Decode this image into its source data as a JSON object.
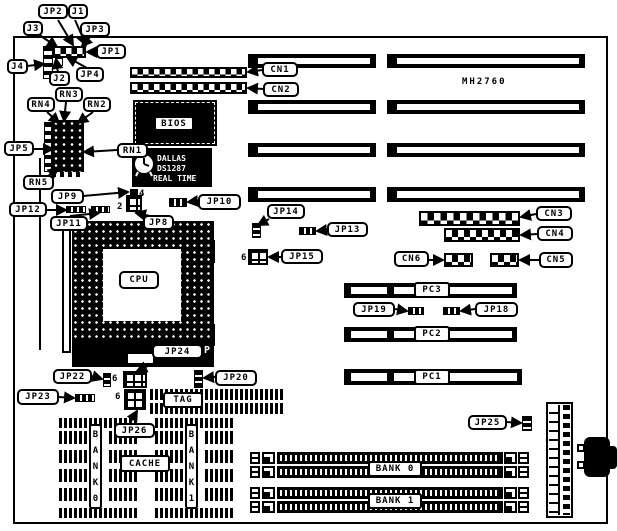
{
  "colors": {
    "ink": "#000000",
    "paper": "#ffffff"
  },
  "board": {
    "model": "MH2760"
  },
  "callouts": {
    "j1": "J1",
    "j2": "J2",
    "j3": "J3",
    "j4": "J4",
    "jp1": "JP1",
    "jp2": "JP2",
    "jp3": "JP3",
    "jp4": "JP4",
    "jp5": "JP5",
    "jp8": "JP8",
    "jp9": "JP9",
    "jp10": "JP10",
    "jp11": "JP11",
    "jp12": "JP12",
    "jp13": "JP13",
    "jp14": "JP14",
    "jp15": "JP15",
    "jp18": "JP18",
    "jp19": "JP19",
    "jp20": "JP20",
    "jp22": "JP22",
    "jp23": "JP23",
    "jp24": "JP24",
    "jp25": "JP25",
    "jp26": "JP26",
    "rn1": "RN1",
    "rn2": "RN2",
    "rn3": "RN3",
    "rn4": "RN4",
    "rn5": "RN5",
    "cn1": "CN1",
    "cn2": "CN2",
    "cn3": "CN3",
    "cn4": "CN4",
    "cn5": "CN5",
    "cn6": "CN6",
    "pc1": "PC1",
    "pc2": "PC2",
    "pc3": "PC3",
    "bios": "BIOS",
    "cpu": "CPU",
    "tag": "TAG",
    "cache": "CACHE",
    "bank0_cache": "BANK0",
    "bank1_cache": "BANK1",
    "bank0_simm": "BANK 0",
    "bank1_simm": "BANK 1"
  },
  "chips": {
    "dallas_brand": "DALLAS",
    "dallas_model": "DS1287",
    "dallas_type": "REAL TIME"
  },
  "pin_markers": {
    "jp8_pin2": "2",
    "jp8_pin4": "4",
    "jp15_pin6": "6",
    "jp24_block_pin6": "6",
    "jp26_block_pin6": "6",
    "socket_p": "P"
  }
}
